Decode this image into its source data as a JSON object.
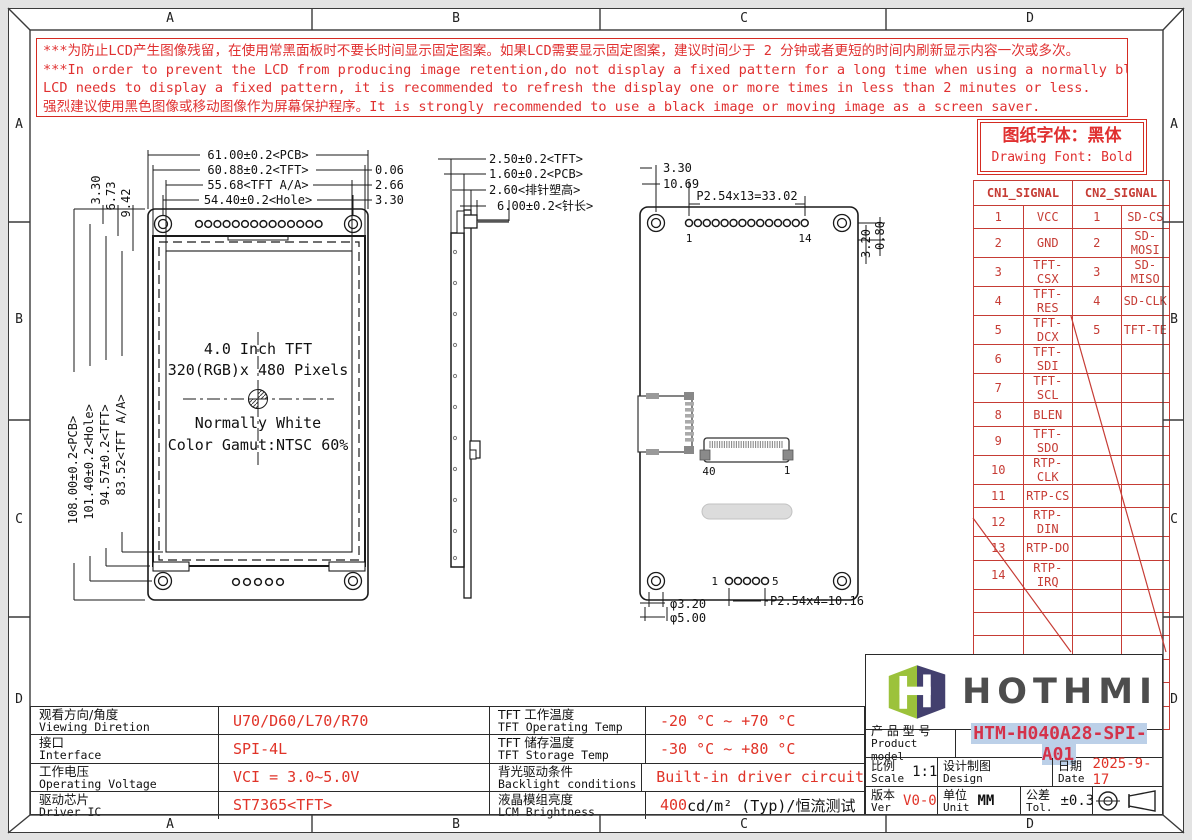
{
  "sheet": {
    "zones": {
      "cols": [
        "A",
        "B",
        "C",
        "D"
      ],
      "rows": [
        "A",
        "B",
        "C",
        "D"
      ]
    },
    "warning": {
      "line1": "***为防止LCD产生图像残留，在使用常黑面板时不要长时间显示固定图案。如果LCD需要显示固定图案，建议时间少于 2 分钟或者更短的时间内刷新显示内容一次或多次。",
      "line2": "***In order to prevent the LCD from producing image retention,do not display a fixed pattern for a long time when using a normally black panel.If the",
      "line3": " LCD needs to display a fixed pattern,  it is recommended to refresh the display one or more times in less than 2 minutes or less.",
      "line4": "强烈建议使用黑色图像或移动图像作为屏幕保护程序。It is strongly recommended to use a black image or moving image as a screen saver."
    },
    "font_note": {
      "cn": "图纸字体：黑体",
      "en": "Drawing Font: Bold"
    }
  },
  "signal_table": {
    "cn1_header": "CN1_SIGNAL",
    "cn2_header": "CN2_SIGNAL",
    "cn1": [
      {
        "pin": "1",
        "name": "VCC"
      },
      {
        "pin": "2",
        "name": "GND"
      },
      {
        "pin": "3",
        "name": "TFT-CSX"
      },
      {
        "pin": "4",
        "name": "TFT-RES"
      },
      {
        "pin": "5",
        "name": "TFT-DCX"
      },
      {
        "pin": "6",
        "name": "TFT-SDI"
      },
      {
        "pin": "7",
        "name": "TFT-SCL"
      },
      {
        "pin": "8",
        "name": "BLEN"
      },
      {
        "pin": "9",
        "name": "TFT-SDO"
      },
      {
        "pin": "10",
        "name": "RTP-CLK"
      },
      {
        "pin": "11",
        "name": "RTP-CS"
      },
      {
        "pin": "12",
        "name": "RTP-DIN"
      },
      {
        "pin": "13",
        "name": "RTP-DO"
      },
      {
        "pin": "14",
        "name": "RTP-IRQ"
      }
    ],
    "cn2": [
      {
        "pin": "1",
        "name": "SD-CS"
      },
      {
        "pin": "2",
        "name": "SD-MOSI"
      },
      {
        "pin": "3",
        "name": "SD-MISO"
      },
      {
        "pin": "4",
        "name": "SD-CLK"
      },
      {
        "pin": "5",
        "name": "TFT-TE"
      }
    ]
  },
  "front_view": {
    "dims_top": [
      "61.00±0.2<PCB>",
      "60.88±0.2<TFT>",
      "55.68<TFT A/A>",
      "54.40±0.2<Hole>"
    ],
    "dims_top_right": [
      "0.06",
      "2.66",
      "3.30"
    ],
    "dims_top_left": [
      "3.30",
      "6.73",
      "9.42"
    ],
    "dims_left": [
      "108.00±0.2<PCB>",
      "101.40±0.2<Hole>",
      "94.57±0.2<TFT>",
      "83.52<TFT A/A>"
    ],
    "center_lines": [
      "4.0 Inch TFT",
      "320(RGB)x 480 Pixels",
      "Normally White",
      "Color Gamut:NTSC 60%"
    ]
  },
  "side_view": {
    "dims": [
      "2.50±0.2<TFT>",
      "1.60±0.2<PCB>",
      "2.60<排针塑高>",
      "6.00±0.2<针长>"
    ]
  },
  "back_view": {
    "dims_top": [
      "3.30",
      "10.69",
      "P2.54x13=33.02"
    ],
    "pin_first": "1",
    "pin_last": "14",
    "dims_right": [
      "3.20",
      "0.80"
    ],
    "conn_left": "40",
    "conn_right": "1",
    "bottom_pin_first": "1",
    "bottom_pin_last": "5",
    "dims_bottom": [
      "φ3.20",
      "φ5.00",
      "P2.54x4=10.16"
    ]
  },
  "spec_left": {
    "rows": [
      {
        "cn": "观看方向/角度",
        "en": "Viewing Diretion",
        "value": "U70/D60/L70/R70"
      },
      {
        "cn": "接口",
        "en": "Interface",
        "value": "SPI-4L"
      },
      {
        "cn": "工作电压",
        "en": "Operating Voltage",
        "value": "VCI = 3.0~5.0V"
      },
      {
        "cn": "驱动芯片",
        "en": "Driver IC",
        "value": "ST7365<TFT>"
      }
    ]
  },
  "spec_mid": {
    "rows": [
      {
        "cn": "TFT 工作温度",
        "en": "TFT Operating Temp",
        "value": "-20 °C ~ +70 °C"
      },
      {
        "cn": "TFT 储存温度",
        "en": "TFT Storage Temp",
        "value": "-30 °C ~ +80 °C"
      },
      {
        "cn": "背光驱动条件",
        "en": "Backlight conditions",
        "value": "Built-in driver circuit"
      },
      {
        "cn": "液晶模组亮度",
        "en": "LCM Brightness",
        "value_red": "400",
        "value_rest": " cd/m² (Typ)/恒流测试"
      }
    ]
  },
  "title_block": {
    "brand": "HOTHMI",
    "product": {
      "label_cn": "产 品 型 号",
      "label_en": "Product model",
      "value": "HTM-H040A28-SPI-A01"
    },
    "scale": {
      "label_cn": "比例",
      "label_en": "Scale",
      "value": "1:1"
    },
    "design": {
      "label_cn": "设计制图",
      "label_en": "Design",
      "value": ""
    },
    "date": {
      "label_cn": "日期",
      "label_en": "Date",
      "value": "2025-9-17"
    },
    "ver": {
      "label_cn": "版本",
      "label_en": "Ver",
      "value": "V0-0"
    },
    "unit": {
      "label_cn": "单位",
      "label_en": "Unit",
      "value": "MM"
    },
    "tol": {
      "label_cn": "公差",
      "label_en": "Tol.",
      "value": "±0.3"
    }
  },
  "colors": {
    "accent_red": "#d42b22",
    "table_red": "#c63c35",
    "value_red": "#e03328",
    "model_highlight": "#bcd0e8",
    "logo_green": "#9cc23b",
    "logo_purple": "#43406e"
  }
}
